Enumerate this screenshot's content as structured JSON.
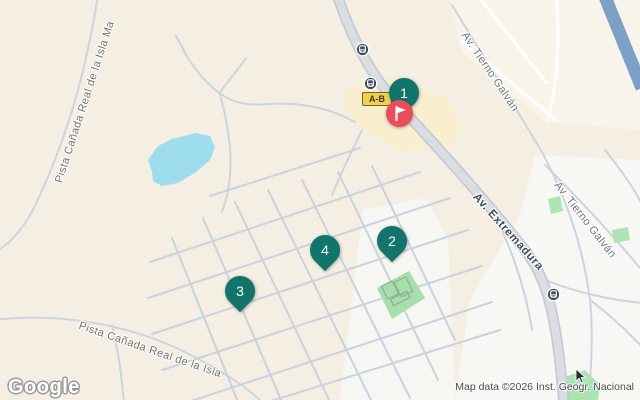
{
  "app": "google-maps-embed",
  "watermark": {
    "text": "Google"
  },
  "attribution": {
    "text": "Map data ©2026 Inst. Geogr. Nacional"
  },
  "road_badge": {
    "text": "A-B"
  },
  "street_labels": [
    {
      "id": "pista-canada-left",
      "text": "Pista Cañada Real de la Isla Ma"
    },
    {
      "id": "pista-canada-bottom",
      "text": "Pista Cañada Real de la Isla"
    },
    {
      "id": "av-tierno-galvan-1",
      "text": "Av. Tierno Galván"
    },
    {
      "id": "av-tierno-galvan-2",
      "text": "Av. Tierno Galván"
    },
    {
      "id": "av-extremadura",
      "text": "Av. Extremadura"
    }
  ],
  "markers": {
    "m1": "1",
    "m2": "2",
    "m3": "3",
    "m4": "4"
  },
  "icons": {
    "bus_stops": [
      "bus-stop-icon",
      "bus-stop-icon",
      "bus-stop-icon"
    ],
    "destination": "destination-flag-icon",
    "cursor": "mouse-pointer-icon"
  },
  "colors": {
    "land_beige": "#f4efe2",
    "urban_white": "#f7f7f3",
    "commercial_yellow": "#f9efcf",
    "lake_blue": "#9edded",
    "park_green": "#a5dfab",
    "road_fill": "#dadde2",
    "road_casing": "#c2c8d1",
    "motorway_blue": "#7da1c6",
    "marker_teal": "#11756b",
    "destination_red": "#ea4c59",
    "badge_yellow": "#f2d04b",
    "bus_icon_slate": "#3d4b5c"
  }
}
